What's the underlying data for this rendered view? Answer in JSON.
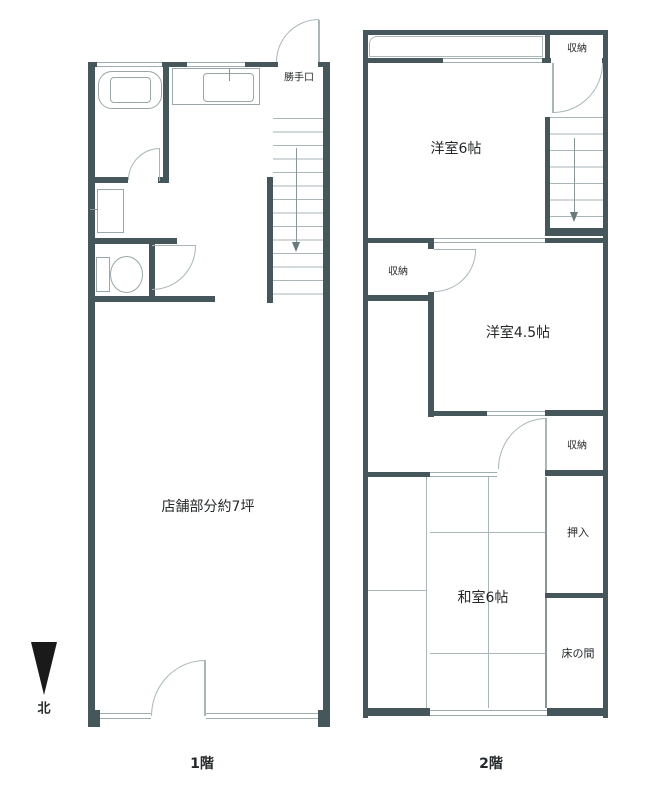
{
  "floor1": {
    "caption": "1階",
    "labels": {
      "back_door": "勝手口",
      "store_area": "店舗部分約7坪"
    },
    "compass_north": "北"
  },
  "floor2": {
    "caption": "2階",
    "labels": {
      "closet_top": "収納",
      "western_room_6": "洋室6帖",
      "closet_mid": "収納",
      "western_room_45": "洋室4.5帖",
      "closet_low": "収納",
      "oshiire": "押入",
      "japanese_room_6": "和室6帖",
      "tokonoma": "床の間"
    }
  },
  "colors": {
    "wall": "#46575c",
    "thin_line": "#a9b5b7",
    "fixture_line": "#9aa6a8",
    "text": "#25282a",
    "north_arrow": "#1a1a1a"
  }
}
